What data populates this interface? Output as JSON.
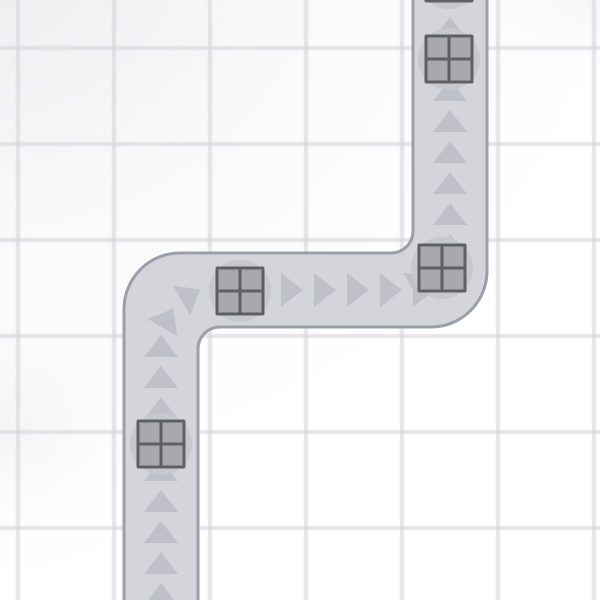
{
  "scene": {
    "canvas": {
      "width": 600,
      "height": 600
    },
    "background": {
      "base_color": "#ffffff",
      "vignette_color": "#dcdce1",
      "grid_line_color": "rgba(203,205,212,0.45)",
      "grid_size": 96,
      "grid_line_width": 4.5,
      "grid_pattern_x": 15.75,
      "grid_pattern_y": 45.75
    },
    "road": {
      "fill": "#d3d5db",
      "border_color": "#9ba0a8",
      "border_width": 3,
      "path": "M 124 612 L 124 309 A 56 56 0 0 1 180 253 L 391 253 A 22 22 0 0 0 413 231 L 413 -12 L 487 -12 L 487 271 A 56 56 0 0 1 431 327 L 220 327 A 22 22 0 0 0 198 349 L 198 612 Z"
    },
    "arrows": {
      "color": "#bfc1c8",
      "width": 34,
      "length": 22,
      "items": [
        [
          161,
          594,
          0
        ],
        [
          161,
          563,
          0
        ],
        [
          161,
          532,
          0
        ],
        [
          161,
          501,
          0
        ],
        [
          161,
          470,
          0
        ],
        [
          161,
          439,
          0
        ],
        [
          161,
          408,
          0
        ],
        [
          161,
          377,
          0
        ],
        [
          161,
          346,
          0
        ],
        [
          168,
          318,
          30
        ],
        [
          191,
          295,
          60
        ],
        [
          226,
          290,
          90
        ],
        [
          259,
          290,
          90
        ],
        [
          292,
          290,
          90
        ],
        [
          325,
          290,
          90
        ],
        [
          358,
          290,
          90
        ],
        [
          391,
          290,
          90
        ],
        [
          424,
          290,
          90
        ],
        [
          421,
          282,
          60
        ],
        [
          442,
          261,
          30
        ],
        [
          450,
          245,
          0
        ],
        [
          450,
          214,
          0
        ],
        [
          450,
          183,
          0
        ],
        [
          450,
          152,
          0
        ],
        [
          450,
          121,
          0
        ],
        [
          450,
          90,
          0
        ],
        [
          450,
          59,
          0
        ],
        [
          450,
          28,
          0
        ]
      ]
    },
    "crates": {
      "size": 49,
      "frame_color": "#5e6064",
      "cell_color": "#a9a9ad",
      "cell_size": 20,
      "shadow_color": "#c6c8ce",
      "shadow_radius": 31,
      "items": [
        [
          161,
          444
        ],
        [
          240,
          291
        ],
        [
          442,
          268
        ],
        [
          449,
          59
        ],
        [
          449,
          -22
        ]
      ]
    }
  }
}
